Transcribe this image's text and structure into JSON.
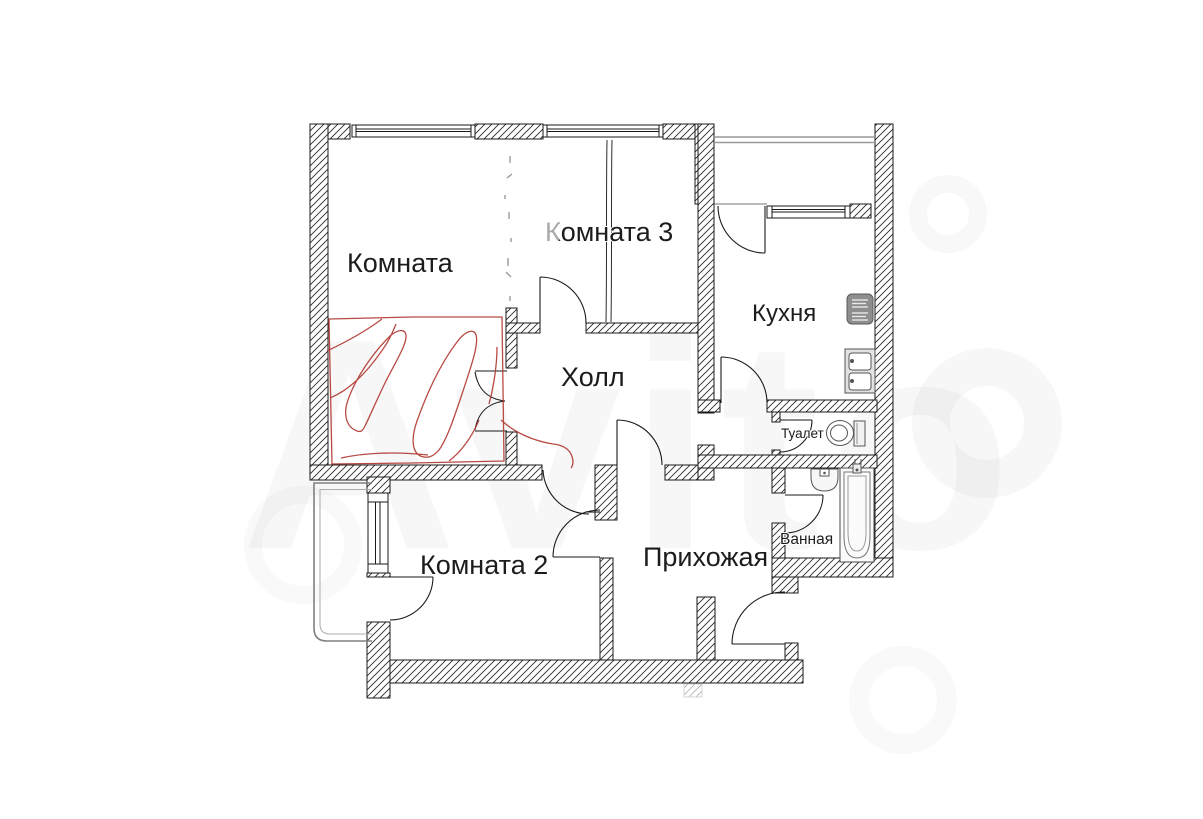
{
  "page": {
    "background": "#ffffff",
    "content": "apartment floor plan"
  },
  "rooms": [
    {
      "key": "room1",
      "label": "Комната"
    },
    {
      "key": "room3",
      "label": "Комната 3"
    },
    {
      "key": "hall",
      "label": "Холл"
    },
    {
      "key": "kitchen",
      "label": "Кухня"
    },
    {
      "key": "toilet",
      "label": "Туалет"
    },
    {
      "key": "bathroom",
      "label": "Ванная"
    },
    {
      "key": "room2",
      "label": "Комната 2"
    },
    {
      "key": "entry",
      "label": "Прихожая"
    }
  ],
  "watermark": {
    "text": "Avito"
  },
  "colors": {
    "wall_outline": "#1a1a1a",
    "hatch_line": "#2b2b2b",
    "highlight_red": "#b23b35",
    "balcony_gray": "#8a8a8a",
    "fixture_gray": "#555555"
  },
  "fixtures": [
    {
      "name": "stove-icon"
    },
    {
      "name": "kitchen-sink-icon"
    },
    {
      "name": "toilet-icon"
    },
    {
      "name": "bath-sink-icon"
    },
    {
      "name": "bathtub-icon"
    }
  ],
  "annotation": {
    "highlight": "red hand-drawn marking over lower part of Комната"
  }
}
